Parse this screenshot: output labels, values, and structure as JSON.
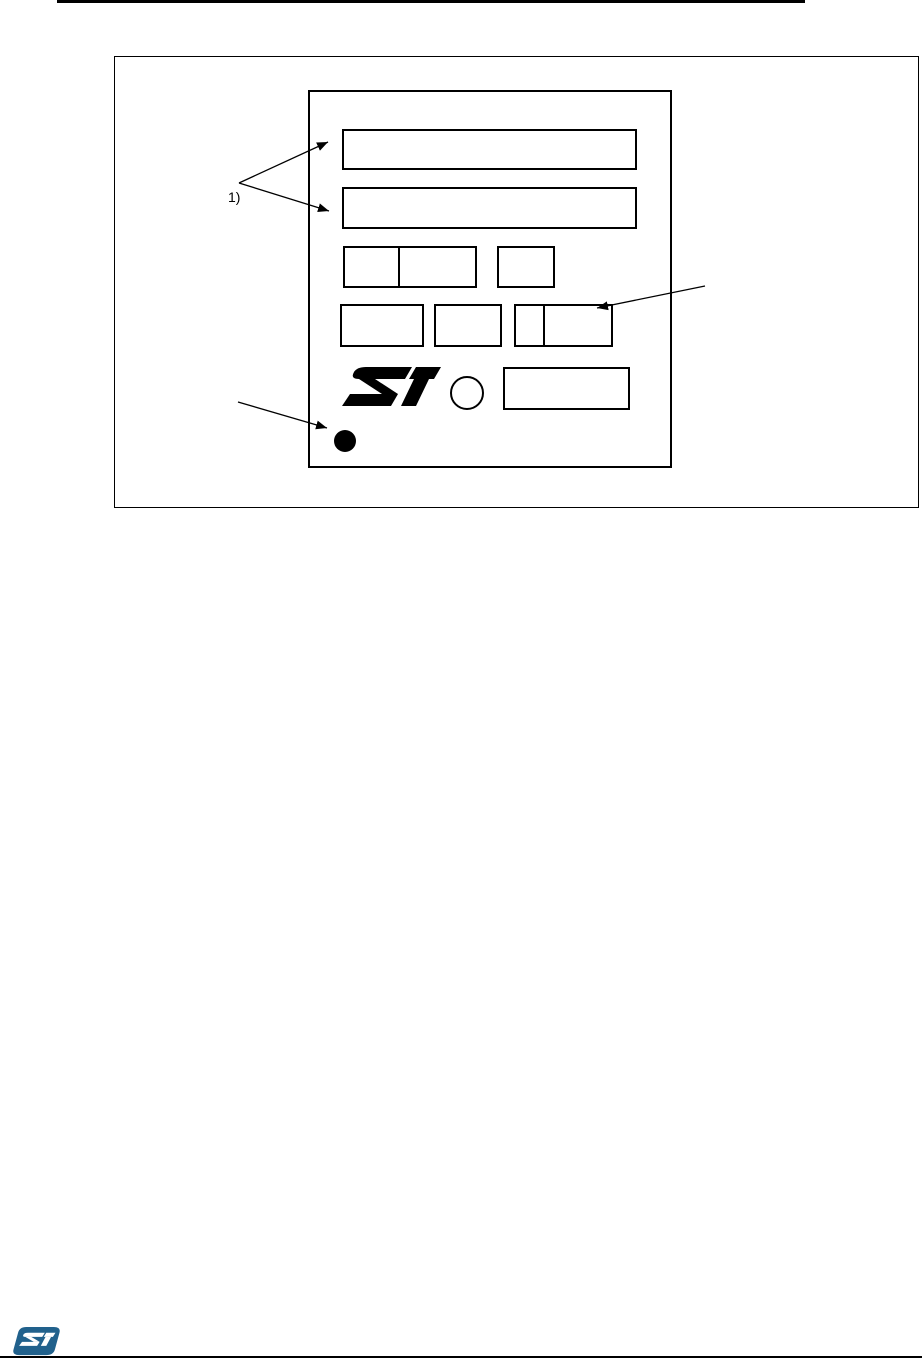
{
  "page": {
    "background_color": "#ffffff",
    "ink_color": "#000000"
  },
  "figure": {
    "note_label": "1)"
  },
  "footer": {
    "logo_color": "#21618c"
  },
  "icons": {
    "marking_logo": "st-logo-icon",
    "footer_logo": "st-logo-icon",
    "pin1_marker": "pin1-dot-icon",
    "pin_circle": "pin-circle-icon",
    "annotation_arrows": "arrow-icon"
  }
}
